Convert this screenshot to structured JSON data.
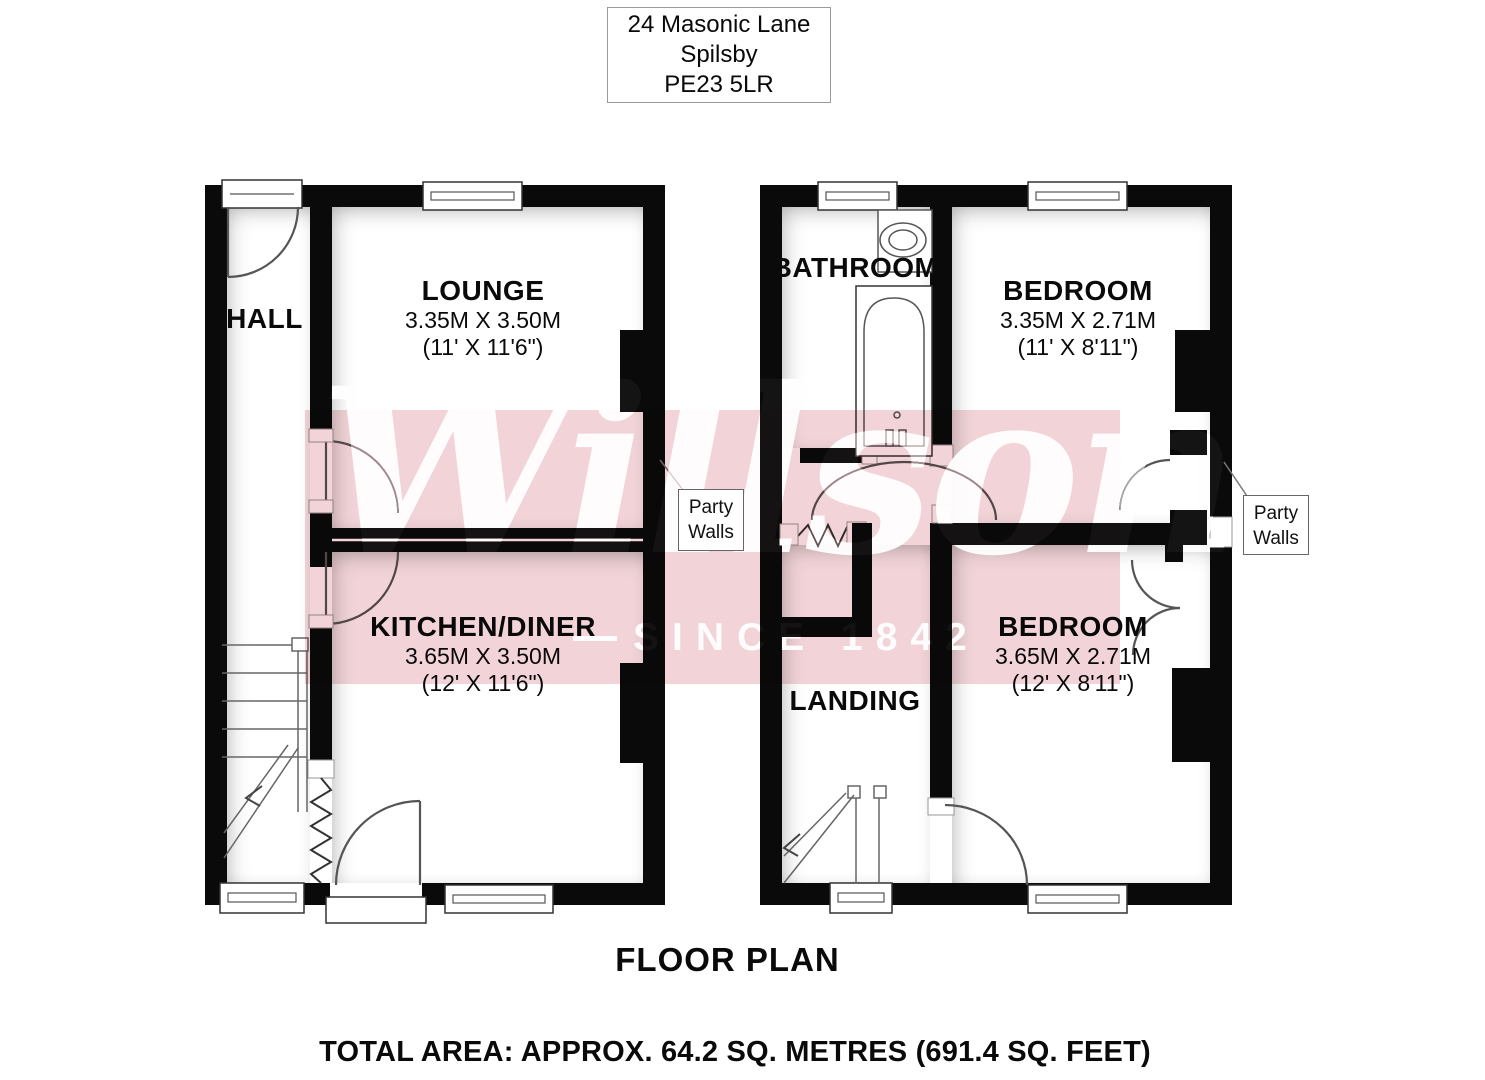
{
  "address": {
    "line1": "24 Masonic Lane",
    "line2": "Spilsby",
    "line3": "PE23 5LR"
  },
  "ground_floor": {
    "rooms": [
      {
        "name": "HALL"
      },
      {
        "name": "LOUNGE",
        "dim_m": "3.35M X 3.50M",
        "dim_ft": "(11' X 11'6\")"
      },
      {
        "name": "KITCHEN/DINER",
        "dim_m": "3.65M X 3.50M",
        "dim_ft": "(12' X 11'6\")"
      }
    ]
  },
  "first_floor": {
    "rooms": [
      {
        "name": "BATHROOM"
      },
      {
        "name": "BEDROOM",
        "dim_m": "3.35M X 2.71M",
        "dim_ft": "(11' X 8'11\")"
      },
      {
        "name": "BEDROOM",
        "dim_m": "3.65M X 2.71M",
        "dim_ft": "(12' X 8'11\")"
      },
      {
        "name": "LANDING"
      }
    ]
  },
  "party_walls": [
    {
      "line1": "Party",
      "line2": "Walls"
    },
    {
      "line1": "Party",
      "line2": "Walls"
    }
  ],
  "watermark": {
    "name": "Willsons",
    "tagline": "SINCE 1842"
  },
  "footer": {
    "title": "FLOOR PLAN",
    "total_area": "TOTAL AREA: APPROX. 64.2 SQ. METRES (691.4 SQ. FEET)"
  },
  "colors": {
    "wall": "#0a0a0a",
    "watermark_band": "#f2d4d8",
    "watermark_text": "#ffffff",
    "floor": "#ffffff"
  }
}
